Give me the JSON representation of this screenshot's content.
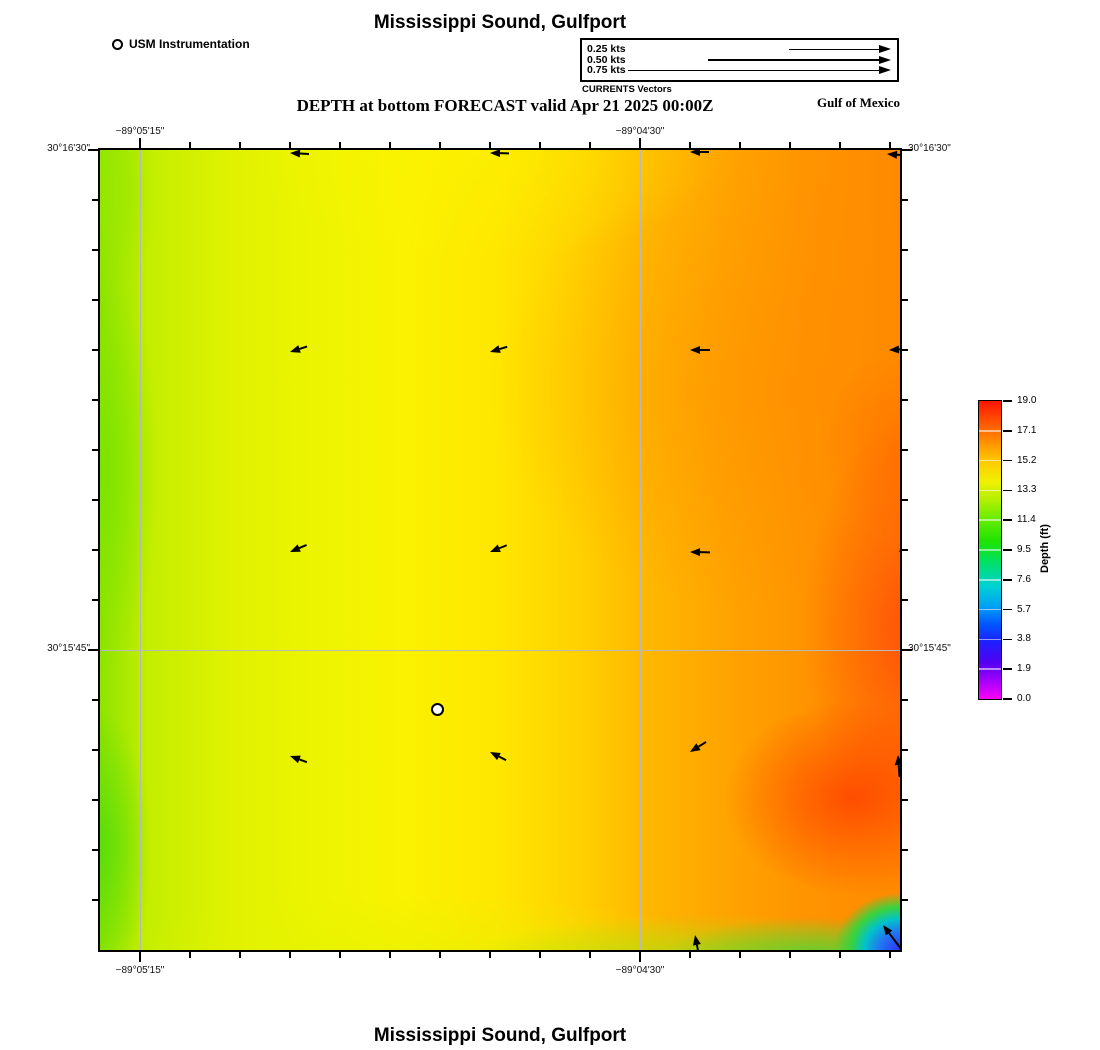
{
  "header": {
    "title": "Mississippi Sound, Gulfport",
    "subtitle": "DEPTH at bottom FORECAST valid Apr 21 2025 00:00Z",
    "region_label": "Gulf of Mexico",
    "instrumentation_legend": {
      "marker_icon": "open-circle-marker",
      "label": "USM Instrumentation"
    },
    "currents_legend": {
      "caption": "CURRENTS Vectors",
      "entries": [
        {
          "label": "0.25 kts",
          "speed_kts": 0.25,
          "tail_px": 90
        },
        {
          "label": "0.50 kts",
          "speed_kts": 0.5,
          "tail_px": 171
        },
        {
          "label": "0.75 kts",
          "speed_kts": 0.75,
          "tail_px": 251
        }
      ]
    }
  },
  "map": {
    "top_axis_labels": [
      {
        "text": "−89°05'15\"",
        "frac": 0.05
      },
      {
        "text": "−89°04'30\"",
        "frac": 0.675
      }
    ],
    "bottom_axis_labels": [
      {
        "text": "−89°05'15\"",
        "frac": 0.05
      },
      {
        "text": "−89°04'30\"",
        "frac": 0.675
      }
    ],
    "left_axis_labels": [
      {
        "text": "30°16'30\"",
        "frac": 0.0
      },
      {
        "text": "30°15'45\"",
        "frac": 0.625
      }
    ],
    "right_axis_labels": [
      {
        "text": "30°16'30\"",
        "frac": 0.0
      },
      {
        "text": "30°15'45\"",
        "frac": 0.625
      }
    ],
    "gridlines": {
      "x_frac": [
        0.05,
        0.675
      ],
      "y_frac": [
        0.625
      ]
    },
    "station_marker": {
      "icon": "open-circle-marker",
      "fx": 0.42125,
      "fy": 0.69875
    }
  },
  "colorbar": {
    "axis_label": "Depth (ft)",
    "tick_labels": [
      "19.0",
      "17.1",
      "15.2",
      "13.3",
      "11.4",
      "9.5",
      "7.6",
      "5.7",
      "3.8",
      "1.9",
      "0.0"
    ],
    "colors_top_to_bottom": [
      "#ff1400",
      "#ff6e00",
      "#ffc800",
      "#b4f000",
      "#41e800",
      "#00e164",
      "#00d2d2",
      "#0064ff",
      "#1e1eff",
      "#6400f0",
      "#fa00fa"
    ]
  },
  "footer": {
    "title": "Mississippi Sound, Gulfport"
  },
  "chart_data": {
    "type": "heatmap",
    "title": "Mississippi Sound, Gulfport",
    "subtitle": "DEPTH at bottom FORECAST valid Apr 21 2025 00:00Z",
    "x_tick_labels": [
      "−89°05'15\"",
      "−89°04'30\""
    ],
    "y_tick_labels": [
      "30°16'30\"",
      "30°15'45\""
    ],
    "colorbar": {
      "label": "Depth (ft)",
      "min": 0.0,
      "max": 19.0,
      "ticks": [
        19.0,
        17.1,
        15.2,
        13.3,
        11.4,
        9.5,
        7.6,
        5.7,
        3.8,
        1.9,
        0.0
      ]
    },
    "depth_grid_ft": {
      "note": "approximate depths read from color field; columns west to east, rows north to south",
      "rows": [
        [
          14.0,
          14.8,
          15.3,
          16.3,
          16.8
        ],
        [
          14.3,
          15.0,
          15.8,
          16.8,
          17.3
        ],
        [
          14.3,
          15.1,
          16.0,
          17.3,
          18.2
        ],
        [
          14.0,
          15.2,
          16.5,
          17.8,
          18.4
        ],
        [
          13.5,
          14.8,
          15.5,
          14.0,
          8.0
        ]
      ]
    },
    "current_vectors": {
      "legend_speeds_kts": [
        0.25,
        0.5,
        0.75
      ],
      "deg_convention": "screen rotation clockwise from east; 180 = flowing west, 270 = flowing north",
      "stations": [
        {
          "fx": 0.2375,
          "fy": 0.004,
          "deg": 183,
          "tail": 9
        },
        {
          "fx": 0.4875,
          "fy": 0.004,
          "deg": 181,
          "tail": 9
        },
        {
          "fx": 0.7375,
          "fy": 0.003,
          "deg": 180,
          "tail": 9
        },
        {
          "fx": 0.984,
          "fy": 0.005,
          "deg": 184,
          "tail": 9
        },
        {
          "fx": 0.2375,
          "fy": 0.2525,
          "deg": 162,
          "tail": 8
        },
        {
          "fx": 0.4875,
          "fy": 0.2525,
          "deg": 163,
          "tail": 8
        },
        {
          "fx": 0.7375,
          "fy": 0.25,
          "deg": 180,
          "tail": 10
        },
        {
          "fx": 0.9865,
          "fy": 0.2505,
          "deg": 177,
          "tail": 10
        },
        {
          "fx": 0.2375,
          "fy": 0.5025,
          "deg": 157,
          "tail": 8
        },
        {
          "fx": 0.4875,
          "fy": 0.5025,
          "deg": 158,
          "tail": 8
        },
        {
          "fx": 0.7375,
          "fy": 0.5025,
          "deg": 181,
          "tail": 10
        },
        {
          "fx": 0.999,
          "fy": 0.503,
          "deg": 142,
          "tail": 9
        },
        {
          "fx": 0.2375,
          "fy": 0.757,
          "deg": 200,
          "tail": 8
        },
        {
          "fx": 0.4875,
          "fy": 0.753,
          "deg": 207,
          "tail": 8
        },
        {
          "fx": 0.7375,
          "fy": 0.753,
          "deg": 148,
          "tail": 9
        },
        {
          "fx": 0.998,
          "fy": 0.7565,
          "deg": 266,
          "tail": 12
        },
        {
          "fx": 0.744,
          "fy": 0.981,
          "deg": 259,
          "tail": 12
        },
        {
          "fx": 0.979,
          "fy": 0.969,
          "deg": 233,
          "tail": 22
        }
      ]
    },
    "instrument_station": {
      "label": "USM Instrumentation",
      "fx": 0.42125,
      "fy": 0.69875
    }
  }
}
